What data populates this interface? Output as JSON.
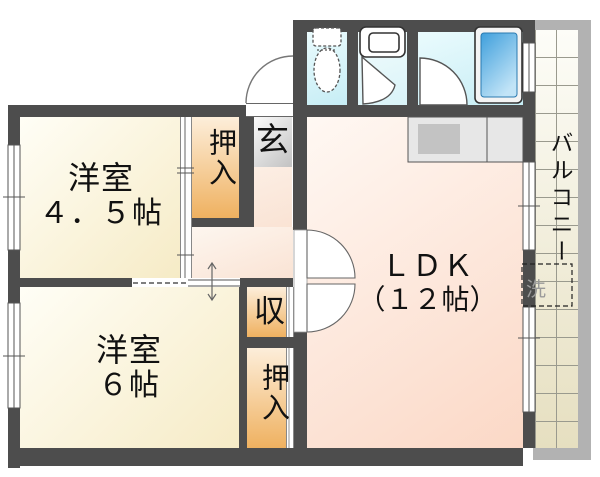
{
  "floorplan": {
    "western_room_1": {
      "name": "洋室",
      "size": "４．５帖"
    },
    "western_room_2": {
      "name": "洋室",
      "size": "６帖"
    },
    "ldk": {
      "name": "ＬＤＫ",
      "size": "（１２帖）"
    },
    "closet_upper": {
      "label": "押入"
    },
    "storage": {
      "label": "収"
    },
    "closet_lower": {
      "label": "押入"
    },
    "entrance": {
      "label": "玄"
    },
    "balcony": {
      "label": "バルコニー"
    },
    "laundry_space": {
      "label": "洗"
    },
    "colors": {
      "wall": "#4d4d4d",
      "room_cream": "#f6ebc6",
      "closet_orange": "#efb160",
      "ldk_pink": "#fbd8c6",
      "wet_area_cyan": "#c6edf5",
      "bathtub_blue": "#49a8e0",
      "balcony_tile": "#e6dfc0",
      "balcony_frame": "#b2b2b2",
      "entrance_gray": "#c2c2c2"
    }
  }
}
